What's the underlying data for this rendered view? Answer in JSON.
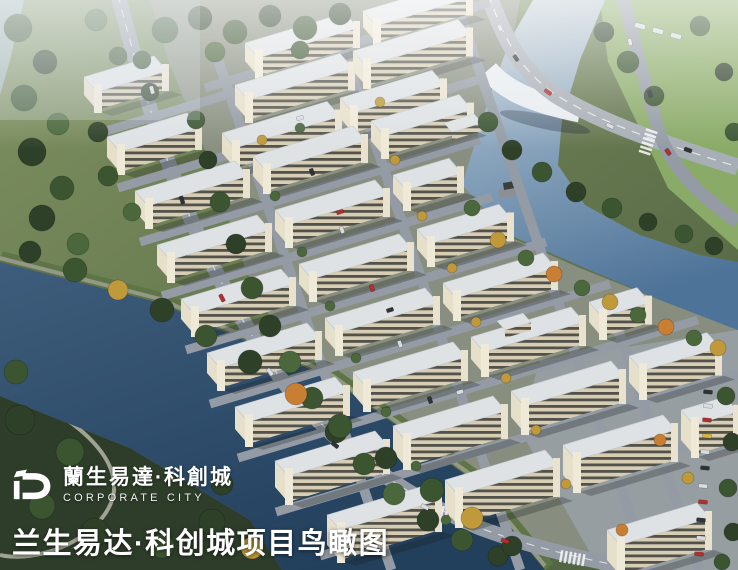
{
  "branding": {
    "logo_cn": "蘭生易達·科創城",
    "logo_en": "CORPORATE CITY"
  },
  "caption": {
    "text": "兰生易达·科创城项目鸟瞰图"
  },
  "scene": {
    "description": "Aerial bird's-eye architectural rendering of the Lansheng Yida Sci-Tech Innovation City business park: diagonal rows of cream low-rise buildings with white roofs, a light-blue river with bridge on the right, a dark navy river at lower left, perimeter roads, trees and parking.",
    "colors": {
      "grass_light": "#7e9160",
      "grass_dark": "#4d5f3e",
      "park_dark": "#2e3d2a",
      "field_bright": "#8fb06a",
      "campus_ground": "#8a9083",
      "paving": "#9aa1a8",
      "road": "#949ba4",
      "road_light": "#a8aeb5",
      "river_dark_top": "#3e5d7c",
      "river_dark_bottom": "#22405c",
      "river_light_top": "#c7cfd4",
      "river_light_mid": "#8aa5bd",
      "river_light_bottom": "#4e7398",
      "roof": "#dee2e5",
      "facade_base": "#d6cdb4",
      "facade_band": "#52524a",
      "end_face": "#e6dfc9",
      "tower": "#efe9d7",
      "bank_green": "#5f7547",
      "path": "#a0a394",
      "haze": "#ffffff",
      "text": "#ffffff"
    },
    "tree_palette": [
      "#2e4128",
      "#3b5531",
      "#4a683c",
      "#c09a3a",
      "#c97f33"
    ],
    "car_palette": [
      "#d8dde0",
      "#b03030",
      "#2e3338",
      "#d8b83a"
    ],
    "buildings": [
      [
        97,
        92,
        70,
        18
      ],
      [
        258,
        58,
        100,
        18
      ],
      [
        376,
        26,
        95,
        16
      ],
      [
        248,
        100,
        105,
        20
      ],
      [
        366,
        66,
        105,
        20
      ],
      [
        120,
        152,
        80,
        20
      ],
      [
        235,
        148,
        105,
        20
      ],
      [
        353,
        113,
        92,
        20
      ],
      [
        148,
        206,
        100,
        20
      ],
      [
        266,
        171,
        100,
        20
      ],
      [
        384,
        136,
        88,
        20
      ],
      [
        170,
        260,
        100,
        20
      ],
      [
        288,
        225,
        100,
        20
      ],
      [
        406,
        190,
        56,
        18
      ],
      [
        194,
        314,
        100,
        20
      ],
      [
        312,
        279,
        100,
        20
      ],
      [
        430,
        244,
        82,
        20
      ],
      [
        220,
        368,
        100,
        20
      ],
      [
        338,
        333,
        100,
        20
      ],
      [
        456,
        298,
        100,
        20
      ],
      [
        248,
        422,
        100,
        22
      ],
      [
        366,
        387,
        100,
        22
      ],
      [
        484,
        352,
        100,
        22
      ],
      [
        602,
        317,
        48,
        20
      ],
      [
        288,
        476,
        100,
        26
      ],
      [
        406,
        441,
        100,
        26
      ],
      [
        524,
        406,
        100,
        26
      ],
      [
        642,
        371,
        78,
        26
      ],
      [
        340,
        530,
        100,
        30
      ],
      [
        458,
        495,
        100,
        30
      ],
      [
        576,
        460,
        100,
        30
      ],
      [
        694,
        425,
        44,
        30
      ],
      [
        620,
        545,
        90,
        30
      ]
    ],
    "pavilions": [
      [
        452,
        132,
        30
      ],
      [
        505,
        330,
        26
      ]
    ],
    "row_roads": [
      [
        205,
        88,
        285
      ],
      [
        96,
        134,
        300
      ],
      [
        118,
        188,
        360
      ],
      [
        140,
        242,
        340
      ],
      [
        162,
        296,
        330
      ],
      [
        186,
        350,
        360
      ],
      [
        210,
        404,
        400
      ],
      [
        238,
        458,
        460
      ],
      [
        276,
        512,
        462
      ],
      [
        320,
        556,
        418
      ]
    ],
    "cross_roads": [
      [
        218,
        60,
        510
      ],
      [
        335,
        25,
        545
      ],
      [
        452,
        -10,
        580
      ],
      [
        608,
        300,
        270
      ]
    ],
    "crosswalks": [
      [
        332,
        443,
        20
      ],
      [
        428,
        508,
        15
      ],
      [
        652,
        130,
        108
      ],
      [
        560,
        556,
        10
      ]
    ],
    "trees": [
      [
        165,
        30,
        13,
        1
      ],
      [
        200,
        18,
        12,
        0
      ],
      [
        235,
        32,
        12,
        1
      ],
      [
        270,
        16,
        11,
        0
      ],
      [
        305,
        28,
        12,
        1
      ],
      [
        340,
        14,
        11,
        0
      ],
      [
        215,
        52,
        10,
        2
      ],
      [
        300,
        50,
        9,
        1
      ],
      [
        18,
        28,
        14,
        1
      ],
      [
        45,
        62,
        12,
        0
      ],
      [
        24,
        98,
        13,
        1
      ],
      [
        58,
        124,
        11,
        2
      ],
      [
        32,
        152,
        14,
        0
      ],
      [
        62,
        188,
        12,
        1
      ],
      [
        42,
        218,
        13,
        0
      ],
      [
        78,
        244,
        11,
        2
      ],
      [
        96,
        20,
        11,
        2
      ],
      [
        118,
        56,
        9,
        1
      ],
      [
        98,
        132,
        10,
        0
      ],
      [
        108,
        176,
        10,
        1
      ],
      [
        132,
        212,
        9,
        2
      ],
      [
        150,
        92,
        9,
        0
      ],
      [
        142,
        60,
        9,
        1
      ],
      [
        196,
        120,
        9,
        1
      ],
      [
        208,
        160,
        9,
        0
      ],
      [
        220,
        202,
        10,
        1
      ],
      [
        236,
        244,
        10,
        0
      ],
      [
        252,
        288,
        11,
        1
      ],
      [
        270,
        326,
        11,
        0
      ],
      [
        290,
        362,
        11,
        2
      ],
      [
        312,
        398,
        11,
        1
      ],
      [
        336,
        432,
        11,
        0
      ],
      [
        364,
        464,
        11,
        1
      ],
      [
        394,
        494,
        11,
        2
      ],
      [
        428,
        520,
        11,
        0
      ],
      [
        462,
        540,
        11,
        1
      ],
      [
        498,
        556,
        10,
        0
      ],
      [
        30,
        252,
        11,
        0
      ],
      [
        75,
        270,
        12,
        1
      ],
      [
        118,
        290,
        10,
        3
      ],
      [
        162,
        310,
        12,
        0
      ],
      [
        206,
        336,
        11,
        1
      ],
      [
        250,
        362,
        12,
        0
      ],
      [
        296,
        394,
        11,
        4
      ],
      [
        340,
        426,
        12,
        1
      ],
      [
        386,
        458,
        11,
        0
      ],
      [
        432,
        490,
        12,
        1
      ],
      [
        472,
        518,
        11,
        3
      ],
      [
        512,
        546,
        10,
        0
      ],
      [
        20,
        420,
        15,
        0
      ],
      [
        70,
        452,
        14,
        1
      ],
      [
        130,
        482,
        15,
        0
      ],
      [
        42,
        506,
        13,
        1
      ],
      [
        95,
        532,
        14,
        0
      ],
      [
        162,
        546,
        12,
        1
      ],
      [
        212,
        522,
        13,
        0
      ],
      [
        252,
        548,
        11,
        3
      ],
      [
        16,
        372,
        12,
        1
      ],
      [
        222,
        484,
        11,
        0
      ],
      [
        472,
        208,
        8,
        2
      ],
      [
        498,
        240,
        8,
        3
      ],
      [
        526,
        258,
        8,
        2
      ],
      [
        554,
        274,
        8,
        4
      ],
      [
        582,
        288,
        8,
        2
      ],
      [
        610,
        302,
        8,
        3
      ],
      [
        638,
        315,
        8,
        2
      ],
      [
        666,
        327,
        8,
        4
      ],
      [
        694,
        338,
        8,
        2
      ],
      [
        718,
        348,
        8,
        3
      ],
      [
        488,
        122,
        10,
        1
      ],
      [
        512,
        150,
        10,
        0
      ],
      [
        542,
        172,
        10,
        1
      ],
      [
        576,
        192,
        10,
        0
      ],
      [
        612,
        208,
        10,
        1
      ],
      [
        648,
        222,
        9,
        0
      ],
      [
        684,
        234,
        9,
        1
      ],
      [
        714,
        246,
        9,
        0
      ],
      [
        628,
        62,
        11,
        1
      ],
      [
        604,
        32,
        10,
        0
      ],
      [
        654,
        96,
        10,
        1
      ],
      [
        700,
        26,
        10,
        1
      ],
      [
        724,
        72,
        9,
        0
      ],
      [
        734,
        132,
        9,
        1
      ],
      [
        726,
        396,
        9,
        1
      ],
      [
        732,
        442,
        9,
        0
      ],
      [
        728,
        488,
        9,
        1
      ],
      [
        733,
        532,
        9,
        0
      ],
      [
        722,
        562,
        8,
        1
      ],
      [
        262,
        140,
        5,
        3
      ],
      [
        300,
        128,
        5,
        2
      ],
      [
        380,
        102,
        5,
        3
      ],
      [
        275,
        196,
        5,
        2
      ],
      [
        395,
        160,
        5,
        3
      ],
      [
        302,
        252,
        5,
        2
      ],
      [
        422,
        216,
        5,
        3
      ],
      [
        330,
        306,
        5,
        2
      ],
      [
        452,
        268,
        5,
        3
      ],
      [
        356,
        358,
        5,
        2
      ],
      [
        476,
        322,
        5,
        3
      ],
      [
        386,
        412,
        5,
        2
      ],
      [
        506,
        378,
        5,
        3
      ],
      [
        416,
        466,
        5,
        2
      ],
      [
        536,
        430,
        5,
        3
      ],
      [
        446,
        520,
        5,
        2
      ],
      [
        566,
        484,
        5,
        3
      ],
      [
        660,
        440,
        6,
        4
      ],
      [
        688,
        478,
        6,
        3
      ],
      [
        622,
        530,
        6,
        4
      ]
    ],
    "cars": [
      [
        500,
        28,
        7,
        4,
        0,
        62
      ],
      [
        516,
        58,
        7,
        4,
        2,
        55
      ],
      [
        548,
        92,
        8,
        4,
        1,
        35
      ],
      [
        610,
        126,
        8,
        4,
        0,
        27
      ],
      [
        688,
        150,
        8,
        4,
        2,
        20
      ],
      [
        630,
        42,
        7,
        4,
        0,
        80
      ],
      [
        650,
        94,
        7,
        4,
        2,
        76
      ],
      [
        668,
        152,
        7,
        4,
        1,
        55
      ],
      [
        640,
        26,
        11,
        5,
        0,
        15
      ],
      [
        658,
        31,
        11,
        5,
        0,
        15
      ],
      [
        676,
        36,
        11,
        5,
        0,
        15
      ],
      [
        152,
        90,
        8,
        4,
        0,
        75
      ],
      [
        182,
        200,
        8,
        4,
        2,
        72
      ],
      [
        222,
        298,
        8,
        4,
        1,
        62
      ],
      [
        270,
        372,
        8,
        4,
        0,
        52
      ],
      [
        335,
        445,
        8,
        4,
        2,
        38
      ],
      [
        425,
        507,
        8,
        4,
        0,
        26
      ],
      [
        505,
        541,
        8,
        4,
        1,
        17
      ],
      [
        312,
        172,
        7,
        4,
        2,
        71
      ],
      [
        342,
        230,
        7,
        4,
        0,
        71
      ],
      [
        372,
        288,
        7,
        4,
        1,
        71
      ],
      [
        400,
        344,
        7,
        4,
        0,
        71
      ],
      [
        430,
        400,
        7,
        4,
        2,
        71
      ],
      [
        300,
        118,
        7,
        4,
        0,
        -17
      ],
      [
        340,
        212,
        7,
        4,
        1,
        -17
      ],
      [
        390,
        310,
        7,
        4,
        2,
        -17
      ],
      [
        460,
        392,
        7,
        4,
        0,
        -17
      ],
      [
        708,
        392,
        9,
        4,
        2,
        5
      ],
      [
        708,
        406,
        9,
        4,
        0,
        5
      ],
      [
        707,
        420,
        9,
        4,
        1,
        5
      ],
      [
        707,
        436,
        9,
        4,
        3,
        5
      ],
      [
        705,
        452,
        9,
        4,
        0,
        5
      ],
      [
        705,
        468,
        9,
        4,
        2,
        5
      ],
      [
        703,
        486,
        9,
        4,
        0,
        5
      ],
      [
        703,
        502,
        9,
        4,
        1,
        5
      ],
      [
        701,
        520,
        9,
        4,
        2,
        5
      ],
      [
        701,
        538,
        9,
        4,
        0,
        5
      ],
      [
        699,
        554,
        9,
        4,
        1,
        5
      ]
    ]
  }
}
